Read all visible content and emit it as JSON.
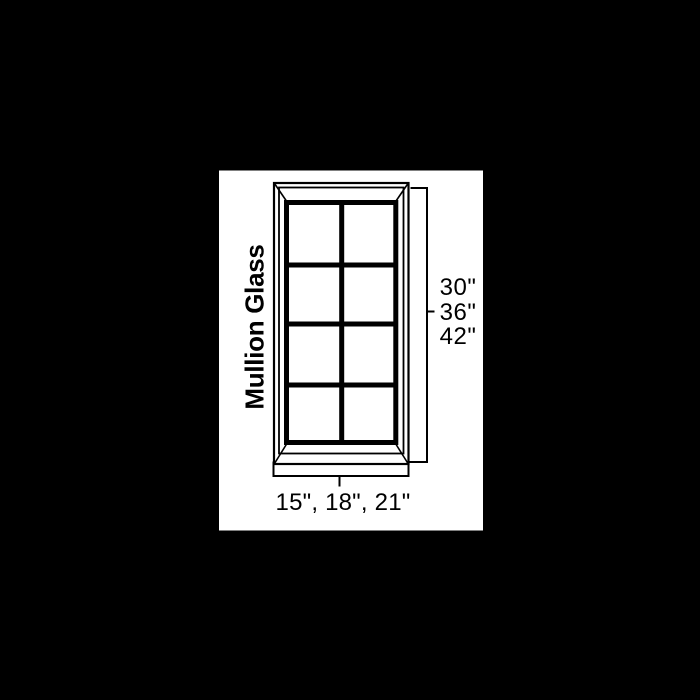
{
  "colors": {
    "background": "#000000",
    "panel": "#ffffff",
    "line": "#000000",
    "text": "#000000"
  },
  "diagram": {
    "label": "Mullion Glass",
    "height_options": [
      "30\"",
      "36\"",
      "42\""
    ],
    "width_options": "15\", 18\", 21\""
  }
}
